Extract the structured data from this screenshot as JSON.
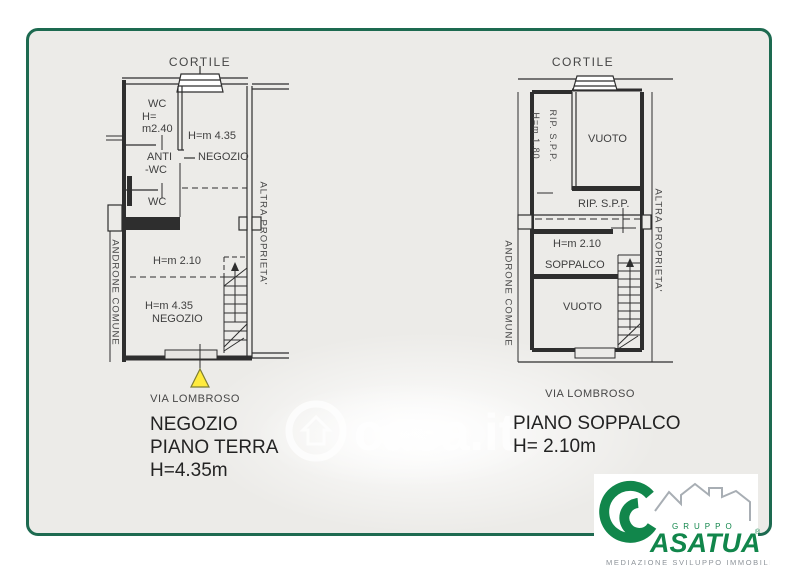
{
  "plans": {
    "left": {
      "cortile": "CORTILE",
      "wc_top": "WC",
      "h_eq": "H=",
      "h_wc": "m2.40",
      "h_negozio_top": "H=m 4.35",
      "anti_line1": "ANTI",
      "anti_line2": "-WC",
      "negozio_top": "NEGOZIO",
      "wc_bottom": "WC",
      "h_mid": "H=m 2.10",
      "h_negozio_bottom": "H=m 4.35",
      "negozio_bottom": "NEGOZIO",
      "left_side": "ANDRONE COMUNE",
      "right_side": "ALTRA PROPRIETA'",
      "street": "VIA LOMBROSO",
      "title": [
        "NEGOZIO",
        "PIANO TERRA",
        "H=4.35m"
      ]
    },
    "right": {
      "cortile": "CORTILE",
      "rip_vertical": "RIP. S.P.P.",
      "h_rip": "H=m 1.80",
      "vuoto_top": "VUOTO",
      "rip_room": "RIP. S.P.P.",
      "h_mid": "H=m 2.10",
      "soppalco": "SOPPALCO",
      "vuoto_bottom": "VUOTO",
      "left_side": "ANDRONE COMUNE",
      "right_side": "ALTRA PROPRIETA'",
      "street": "VIA LOMBROSO",
      "title": [
        "PIANO SOPPALCO",
        "H= 2.10m"
      ]
    }
  },
  "watermark": {
    "text": "casa.it"
  },
  "logo": {
    "gruppo": "GRUPPO",
    "name": "ASATUA",
    "reg": "®",
    "tagline": "MEDIAZIONE SVILUPPO IMMOBILIARE"
  },
  "colors": {
    "frame_green": "#1d6a50",
    "logo_green": "#11864b",
    "marker_yellow": "#ffeb3c"
  }
}
